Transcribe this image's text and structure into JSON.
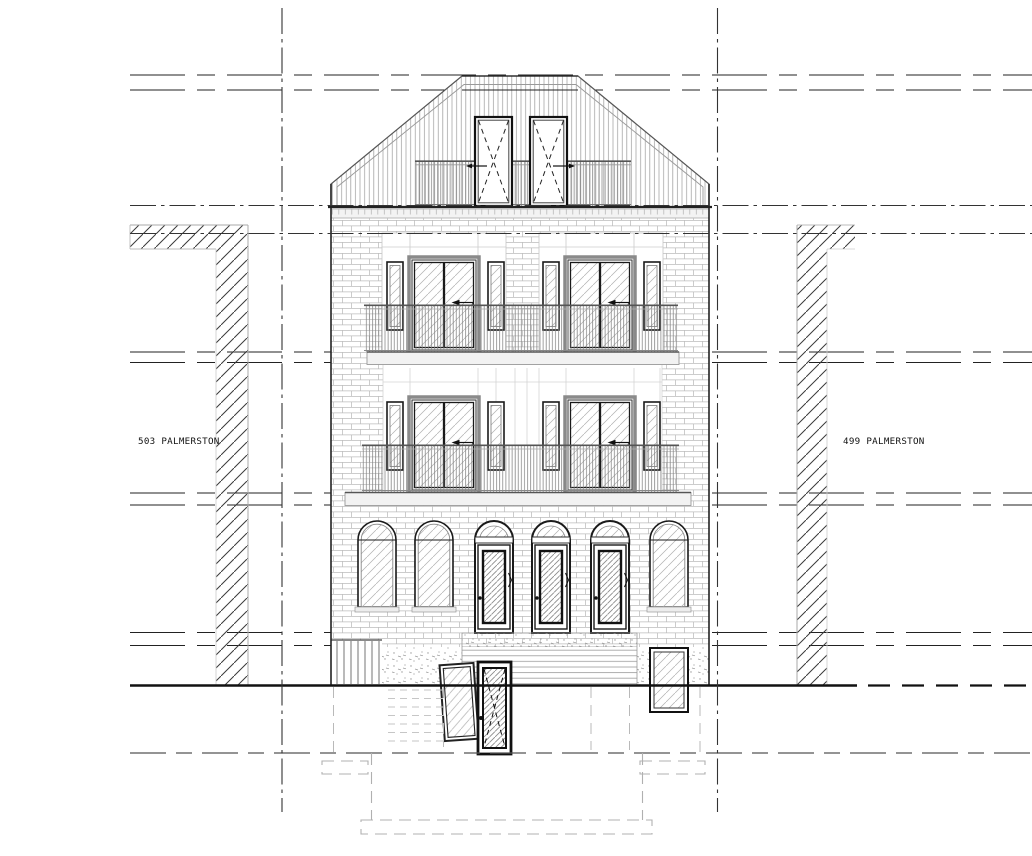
{
  "labels": {
    "left_neighbor": "503 PALMERSTON",
    "right_neighbor": "499 PALMERSTON"
  },
  "colors": {
    "paper": "#ffffff",
    "ink": "#1a1a1a",
    "hatch": "#3a3a3a",
    "light_line": "#999999"
  }
}
